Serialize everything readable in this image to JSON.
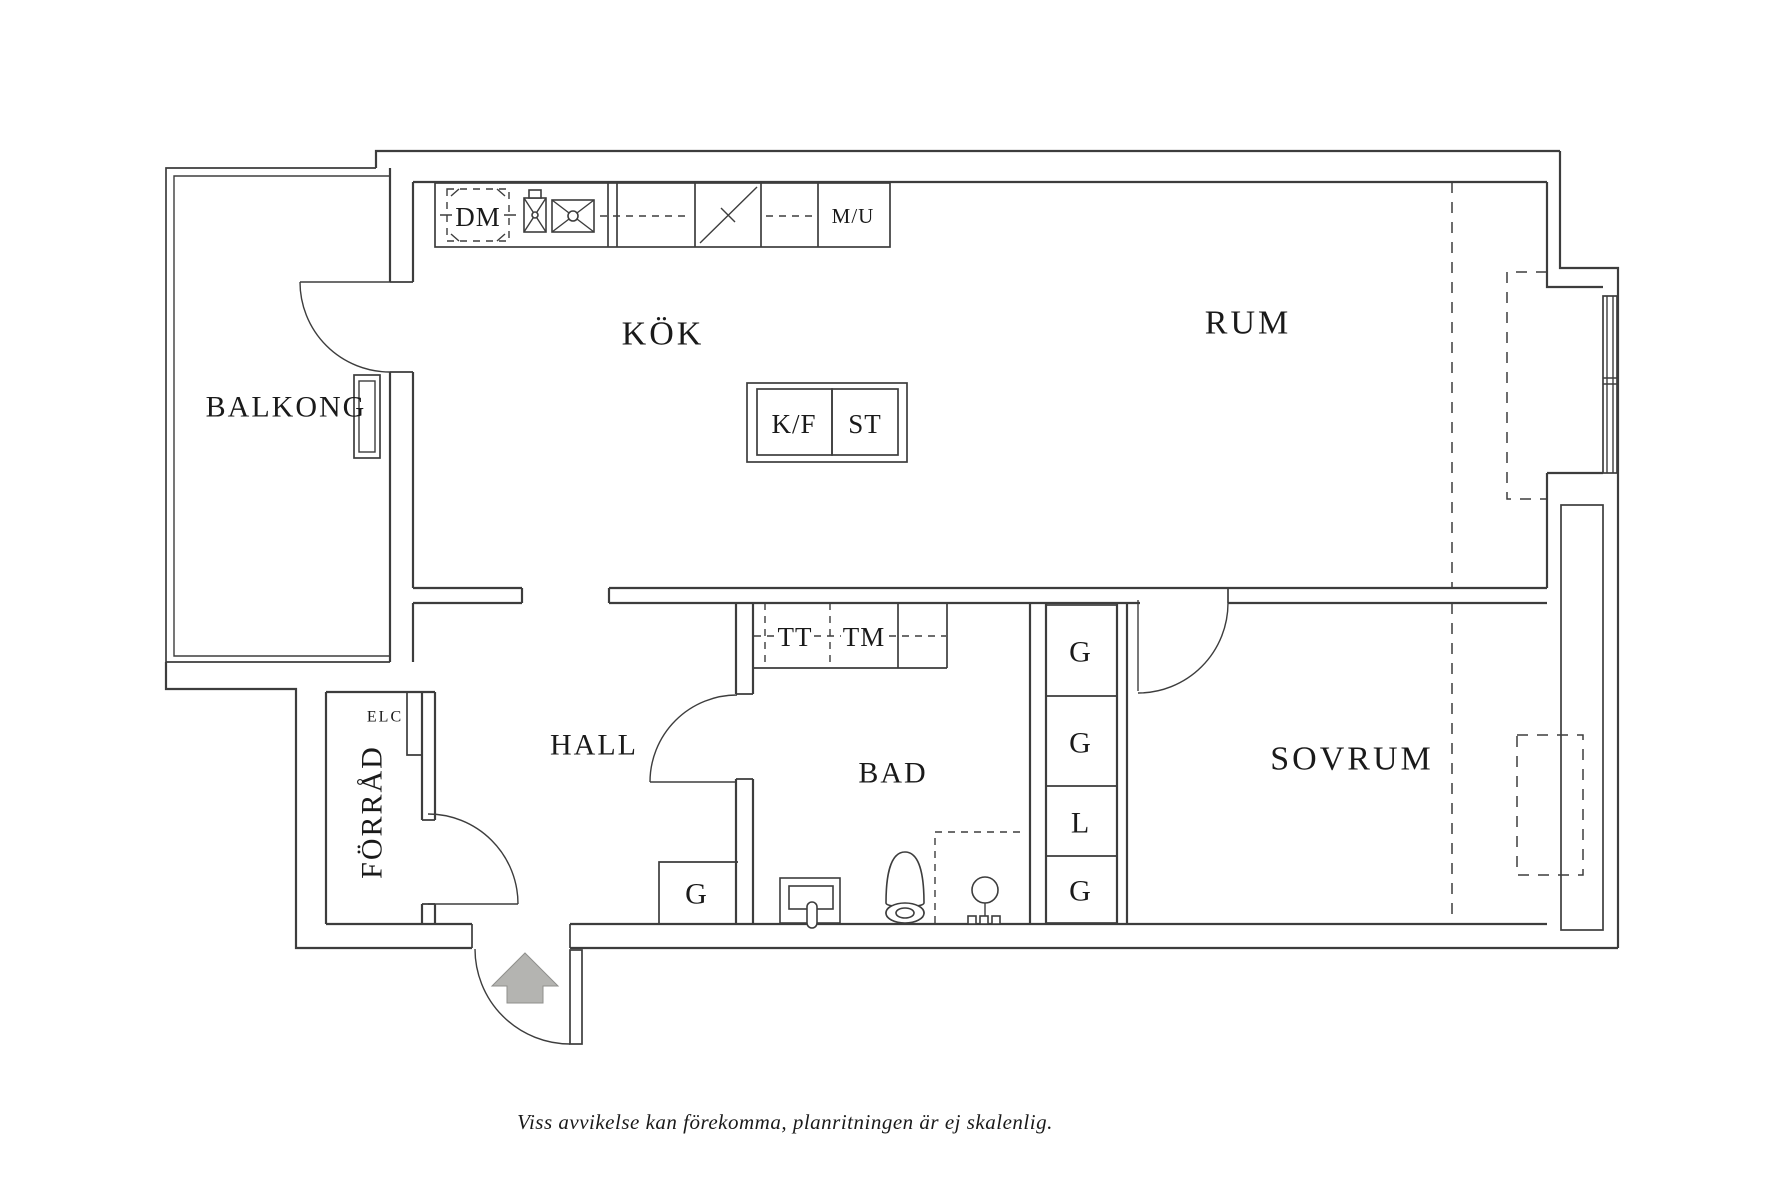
{
  "floorplan": {
    "rooms": {
      "balkong": "BALKONG",
      "kok": "KÖK",
      "rum": "RUM",
      "hall": "HALL",
      "bad": "BAD",
      "sovrum": "SOVRUM",
      "forrad": "FÖRRÅD"
    },
    "appliances": {
      "dm": "DM",
      "mu": "M/U",
      "kf": "K/F",
      "st": "ST",
      "tt": "TT",
      "tm": "TM"
    },
    "closets": {
      "elc": "ELC",
      "column": [
        "G",
        "G",
        "L",
        "G"
      ],
      "hall_g": "G"
    },
    "caption": "Viss avvikelse kan förekomma, planritningen är ej skalenlig.",
    "colors": {
      "line": "#3d3d3d",
      "text": "#1a1a1a",
      "arrow": "#b4b4b1",
      "background": "#ffffff"
    }
  }
}
